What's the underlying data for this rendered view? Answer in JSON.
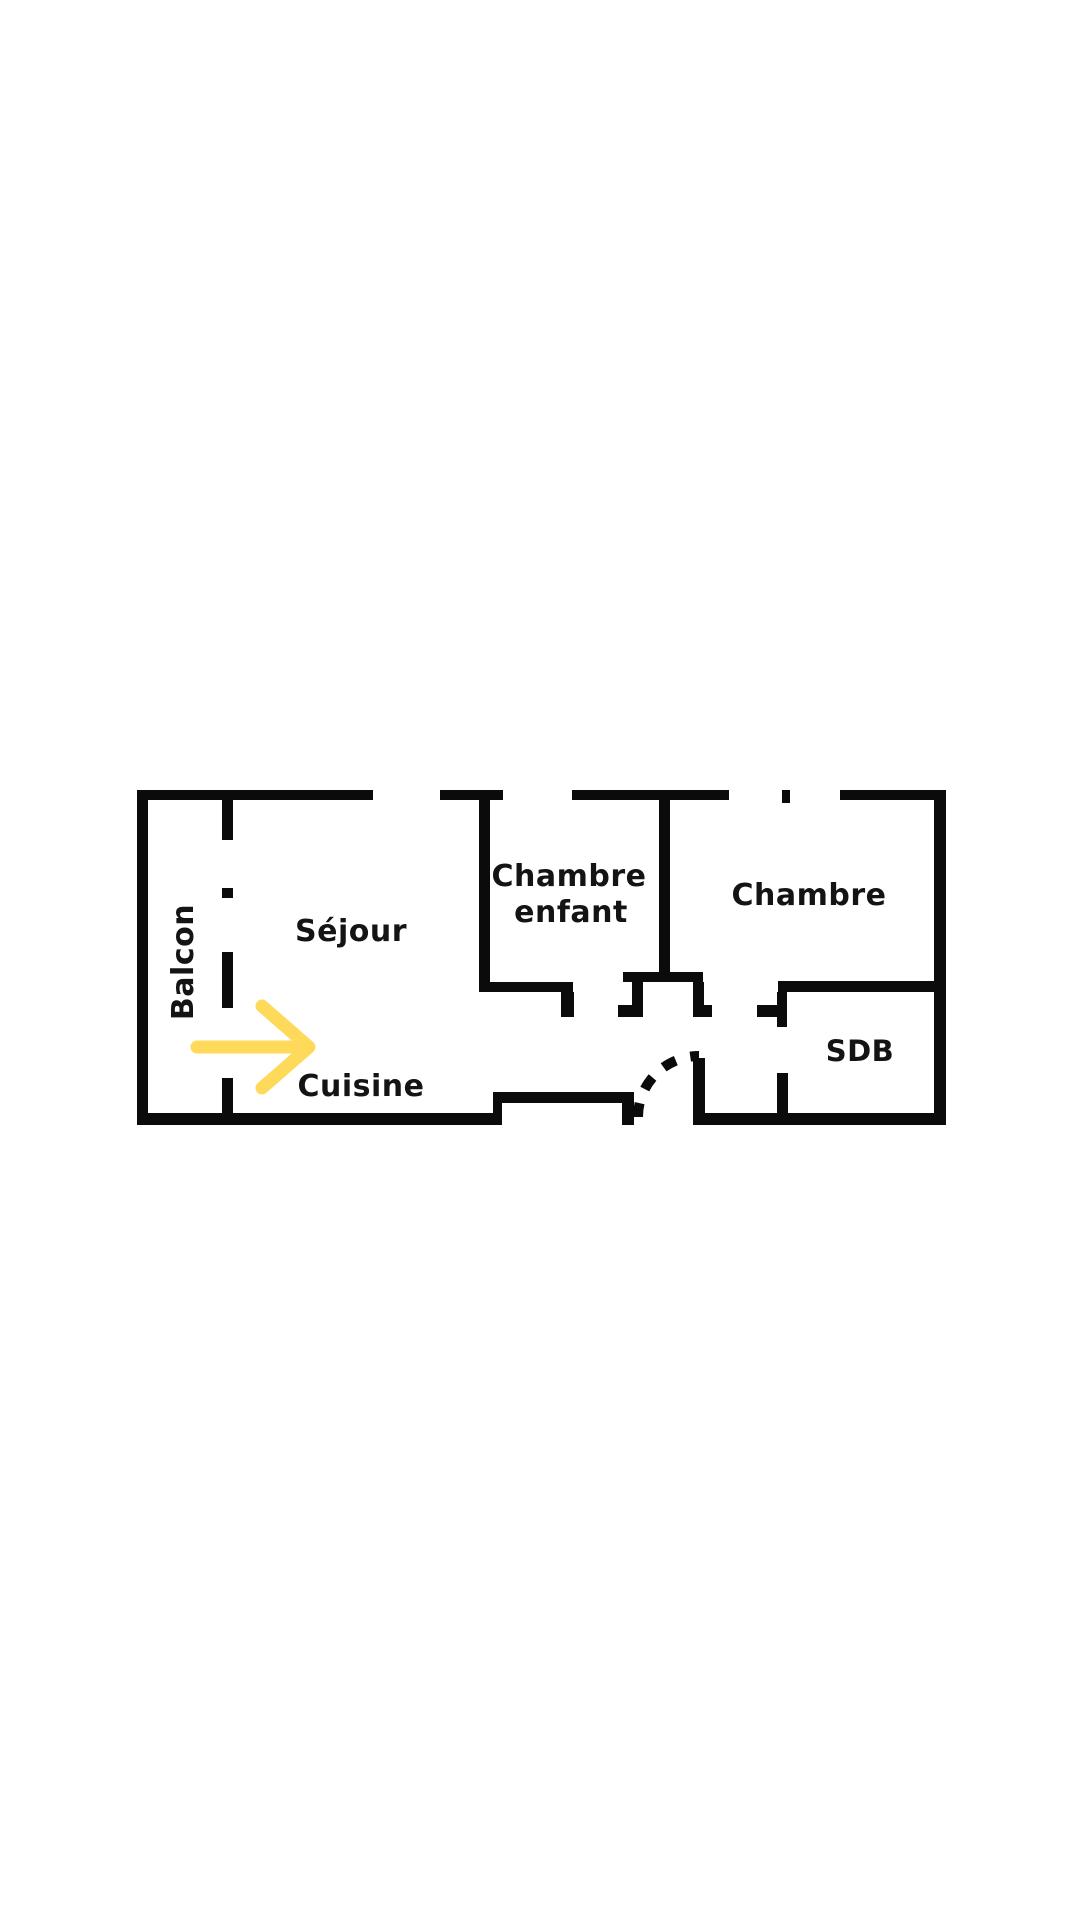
{
  "rooms": {
    "balcon": {
      "label": "Balcon"
    },
    "sejour": {
      "label": "Séjour"
    },
    "chambre_enfant": {
      "label_line1": "Chambre",
      "label_line2": "enfant"
    },
    "chambre": {
      "label": "Chambre"
    },
    "sdb": {
      "label": "SDB"
    },
    "cuisine": {
      "label": "Cuisine"
    }
  },
  "colors": {
    "background": "#FFFFFF",
    "wall": "#0B0B0B",
    "text": "#141414",
    "arrow": "#FFD95A"
  }
}
